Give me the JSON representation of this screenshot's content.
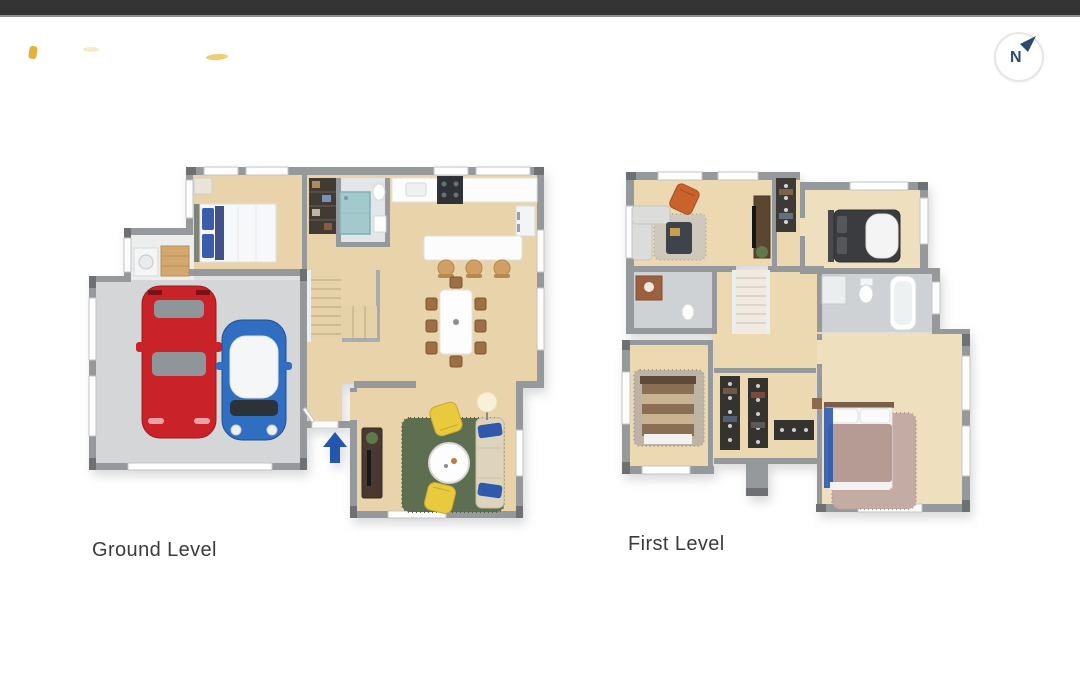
{
  "window": {
    "width": 1080,
    "height": 693
  },
  "top_bar": {
    "color": "#343434"
  },
  "compass": {
    "label": "N",
    "ink": "#2b4a72",
    "ring": "#e6e6e6"
  },
  "watermark": {
    "color": "#e3b13c"
  },
  "plans": [
    {
      "label": "Ground Level",
      "rooms": [
        "garage",
        "laundry",
        "bedroom",
        "bathroom",
        "hallway",
        "stairs",
        "kitchen-dining",
        "living-room",
        "entry"
      ],
      "furniture": [
        "double-bed",
        "washer",
        "laundry-cabinet",
        "red-car",
        "blue-car",
        "hall-wardrobe",
        "teal-shower",
        "kitchen-counter",
        "stove",
        "fridge",
        "island-with-three-stools",
        "dining-table-with-eight-chairs",
        "tv-sideboard",
        "green-rug",
        "two-yellow-armchairs",
        "round-coffee-table",
        "beige-sofa-with-blue-pillows",
        "floor-lamp",
        "blue-entry-arrow"
      ]
    },
    {
      "label": "First Level",
      "rooms": [
        "family-room",
        "wardrobe-nook",
        "bedroom-2",
        "bathroom-2",
        "hallway",
        "stairs",
        "bathroom-3",
        "bedroom-3",
        "walk-in-closet",
        "master-bedroom"
      ],
      "furniture": [
        "orange-armchair",
        "gray-sofa",
        "dark-coffee-table",
        "tv-console",
        "wardrobe",
        "dark-double-bed",
        "toilet",
        "bathtub",
        "shower",
        "copper-vanity",
        "striped-bed",
        "clothes-racks",
        "master-bed-with-blue-runner",
        "mauve-rug"
      ]
    }
  ],
  "colors": {
    "wall_gray": "#96999c",
    "wall_dark": "#6e7174",
    "wood_floor": "#e8d3aa",
    "wood_floor_light": "#eedfbe",
    "garage_floor": "#d4d6d8",
    "tile_floor": "#ced2d5",
    "bath_floor_light": "#e3e6e8",
    "car_red": "#c92229",
    "car_blue": "#2f6ec0",
    "car_roof_white": "#f5f6f7",
    "rug_green": "#5d6f50",
    "rug_gray": "#cfc9bd",
    "rug_mauve": "#c4aba3",
    "rug_taupe": "#bdb4a6",
    "armchair_yellow": "#e9c93e",
    "sofa_beige": "#ded3bd",
    "pillow_blue": "#2e59ac",
    "chair_orange": "#c9622b",
    "bed_dark": "#3a3c40",
    "bed_brown": "#8a6f55",
    "bed_tan": "#c9b391",
    "bed_mauve": "#b59b93",
    "wood_chair": "#9c7044",
    "dark_furniture": "#4a3930",
    "stove_dark": "#2f3337",
    "shower_teal": "#a3c9cc",
    "entry_arrow_blue": "#2456b0",
    "watermark_gold": "#e3b13c",
    "label_text": "#3b3b3d"
  }
}
